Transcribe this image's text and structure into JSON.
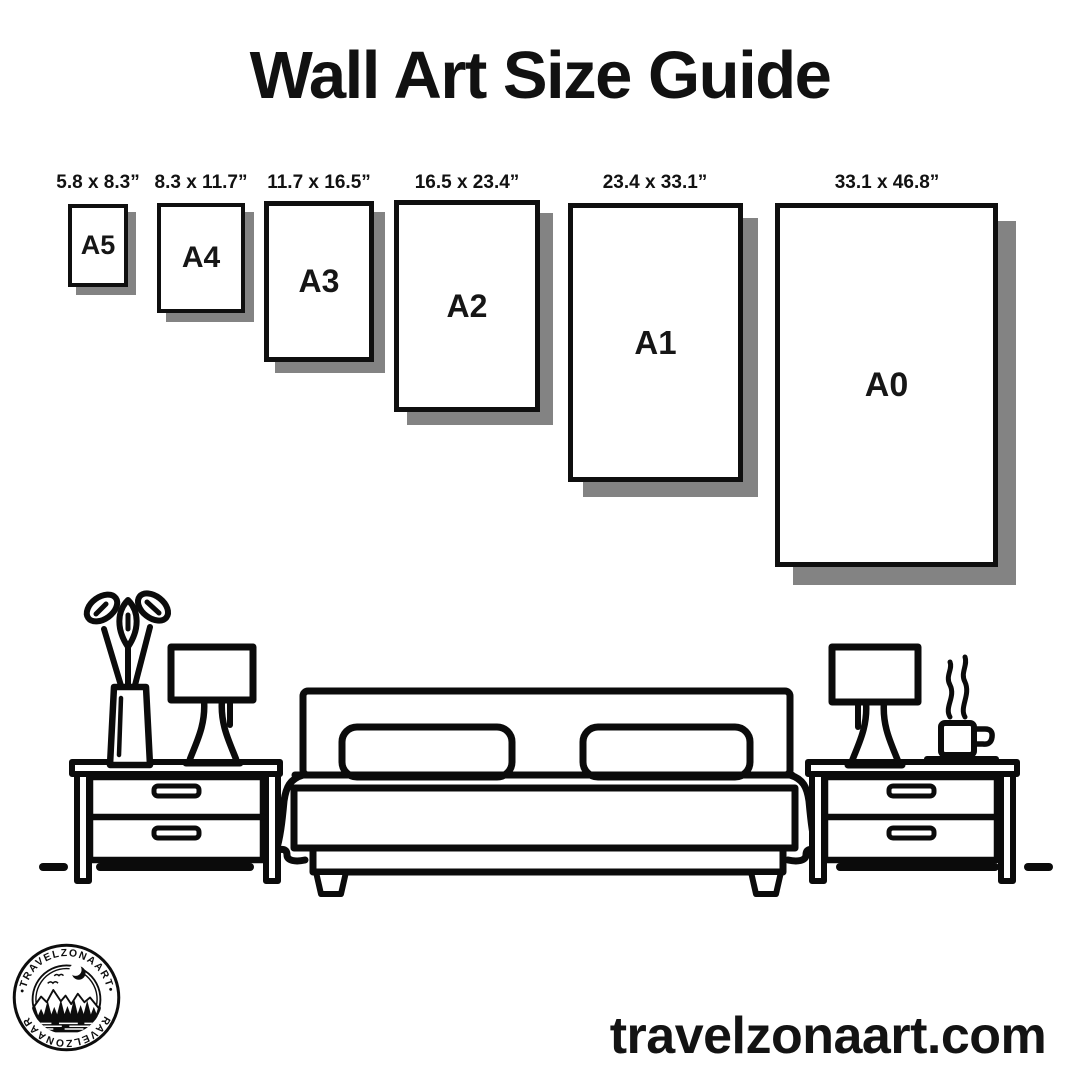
{
  "title": "Wall Art Size Guide",
  "frames": [
    {
      "name": "A5",
      "dims": "5.8 x 8.3”"
    },
    {
      "name": "A4",
      "dims": "8.3 x 11.7”"
    },
    {
      "name": "A3",
      "dims": "11.7 x 16.5”"
    },
    {
      "name": "A2",
      "dims": "16.5 x 23.4”"
    },
    {
      "name": "A1",
      "dims": "23.4 x 33.1”"
    },
    {
      "name": "A0",
      "dims": "33.1 x 46.8”"
    }
  ],
  "logo": {
    "brand_arc_top": "•TRAVELZONAART•",
    "brand_arc_bottom": "•TRAVELZONAART•"
  },
  "footer": {
    "website": "travelzonaart.com"
  },
  "colors": {
    "ink": "#0d0d0d",
    "frame_shadow": "#838383",
    "background": "#ffffff"
  }
}
